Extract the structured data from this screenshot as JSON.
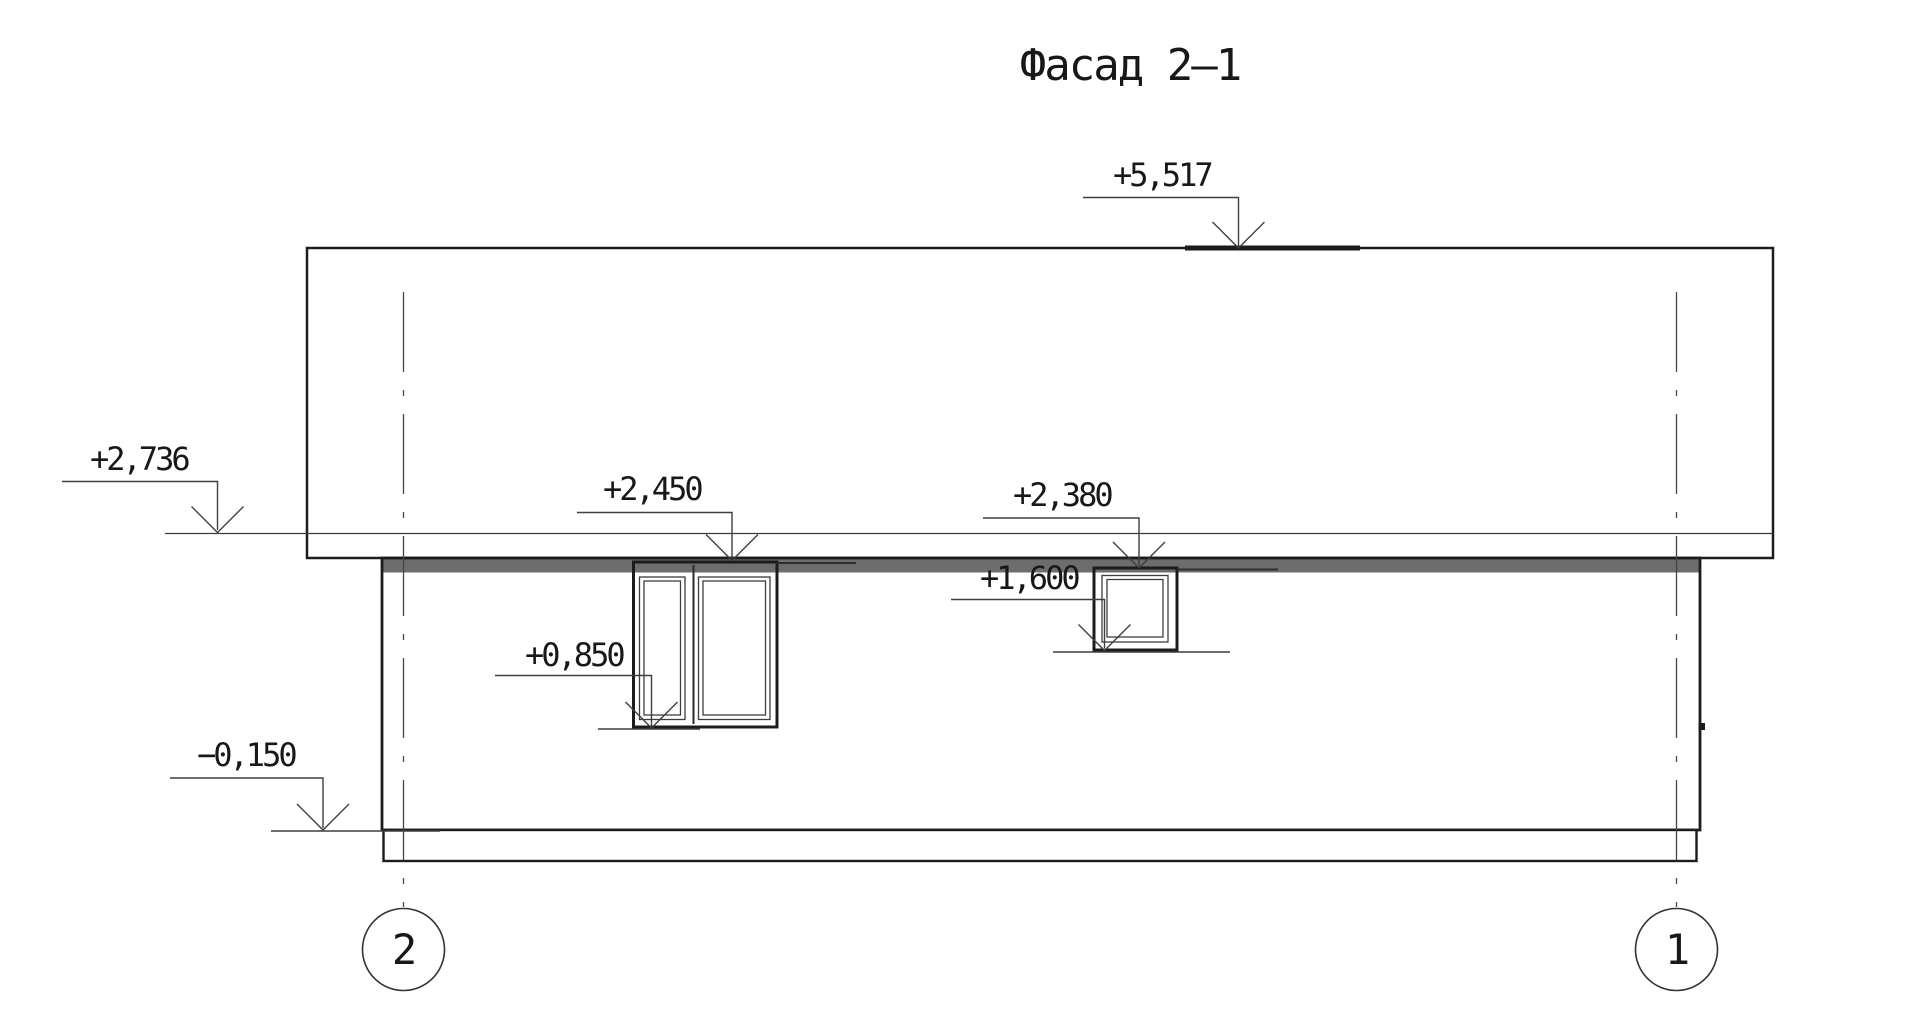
{
  "title": "Фасад 2–1",
  "colors": {
    "ink": "#1c1c1c",
    "thin_line": "#3d3d3d",
    "shadow_band": "#6d6d6d",
    "paper": "#ffffff"
  },
  "elevations": {
    "roof_top": "+5,517",
    "eaves": "+2,736",
    "large_window_head": "+2,450",
    "small_window_head": "+2,380",
    "small_window_sill": "+1,600",
    "large_window_sill": "+0,850",
    "plinth": "−0,150"
  },
  "grid_axes": {
    "left_bubble": "2",
    "right_bubble": "1"
  }
}
